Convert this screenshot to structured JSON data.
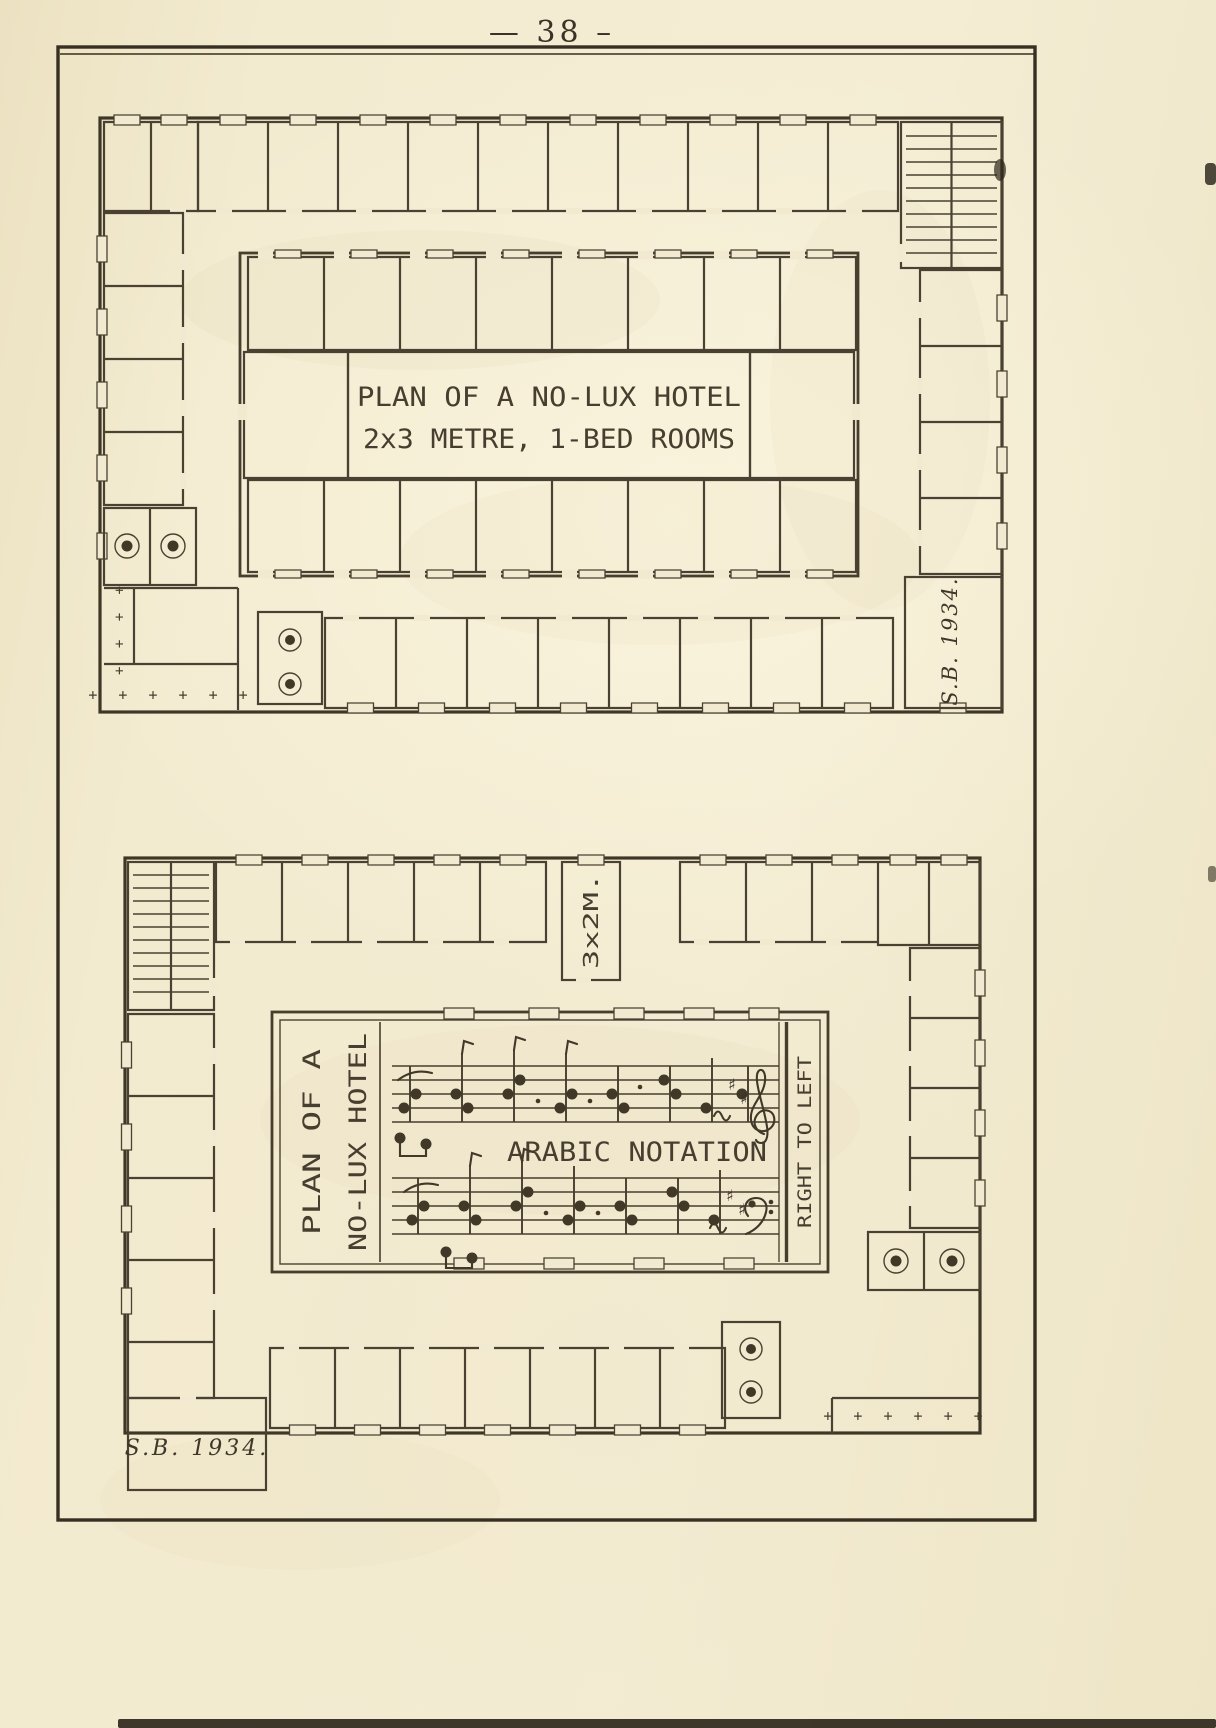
{
  "page": {
    "number": "— 38 –"
  },
  "top_plan": {
    "title_line1": "PLAN OF A NO-LUX HOTEL",
    "title_line2": "2x3 METRE, 1-BED ROOMS",
    "signature": "S.B. 1934.",
    "terrace_marks_horizontal": "+ + + + + +",
    "terrace_marks_vertical": "+ + + +"
  },
  "bottom_plan": {
    "side_title_line1": "PLAN OF A",
    "side_title_line2": "NO-LUX HOTEL",
    "room_dimension_label": "3x2M.",
    "notation_label": "ARABIC NOTATION",
    "direction_label": "RIGHT TO LEFT",
    "signature": "S.B.  1934.",
    "terrace_marks": "+ + + + + +"
  },
  "icons": {
    "sharp": "♯"
  },
  "colors": {
    "paper": "#f2ead0",
    "ink": "#4a4132",
    "frame": "#3a3226"
  }
}
